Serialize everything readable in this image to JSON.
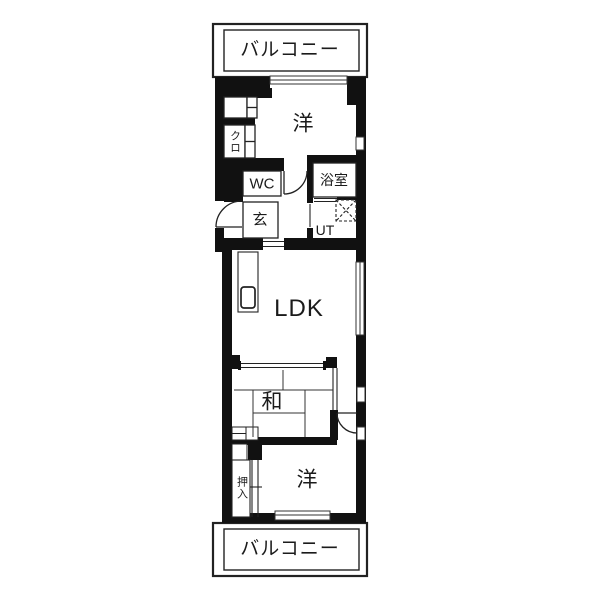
{
  "plan": {
    "type": "apartment-floor-plan",
    "colors": {
      "wall": "#111111",
      "line": "#222222",
      "background": "#ffffff"
    },
    "labels": {
      "balcony_top": "バルコニー",
      "bedroom_top": "洋",
      "closet_kuro": "クロ",
      "wc": "WC",
      "entrance": "玄",
      "bathroom": "浴室",
      "utility": "UT",
      "living": "LDK",
      "japanese_room": "和",
      "oshiire": "押入",
      "bedroom_bottom": "洋",
      "balcony_bottom": "バルコニー"
    }
  }
}
